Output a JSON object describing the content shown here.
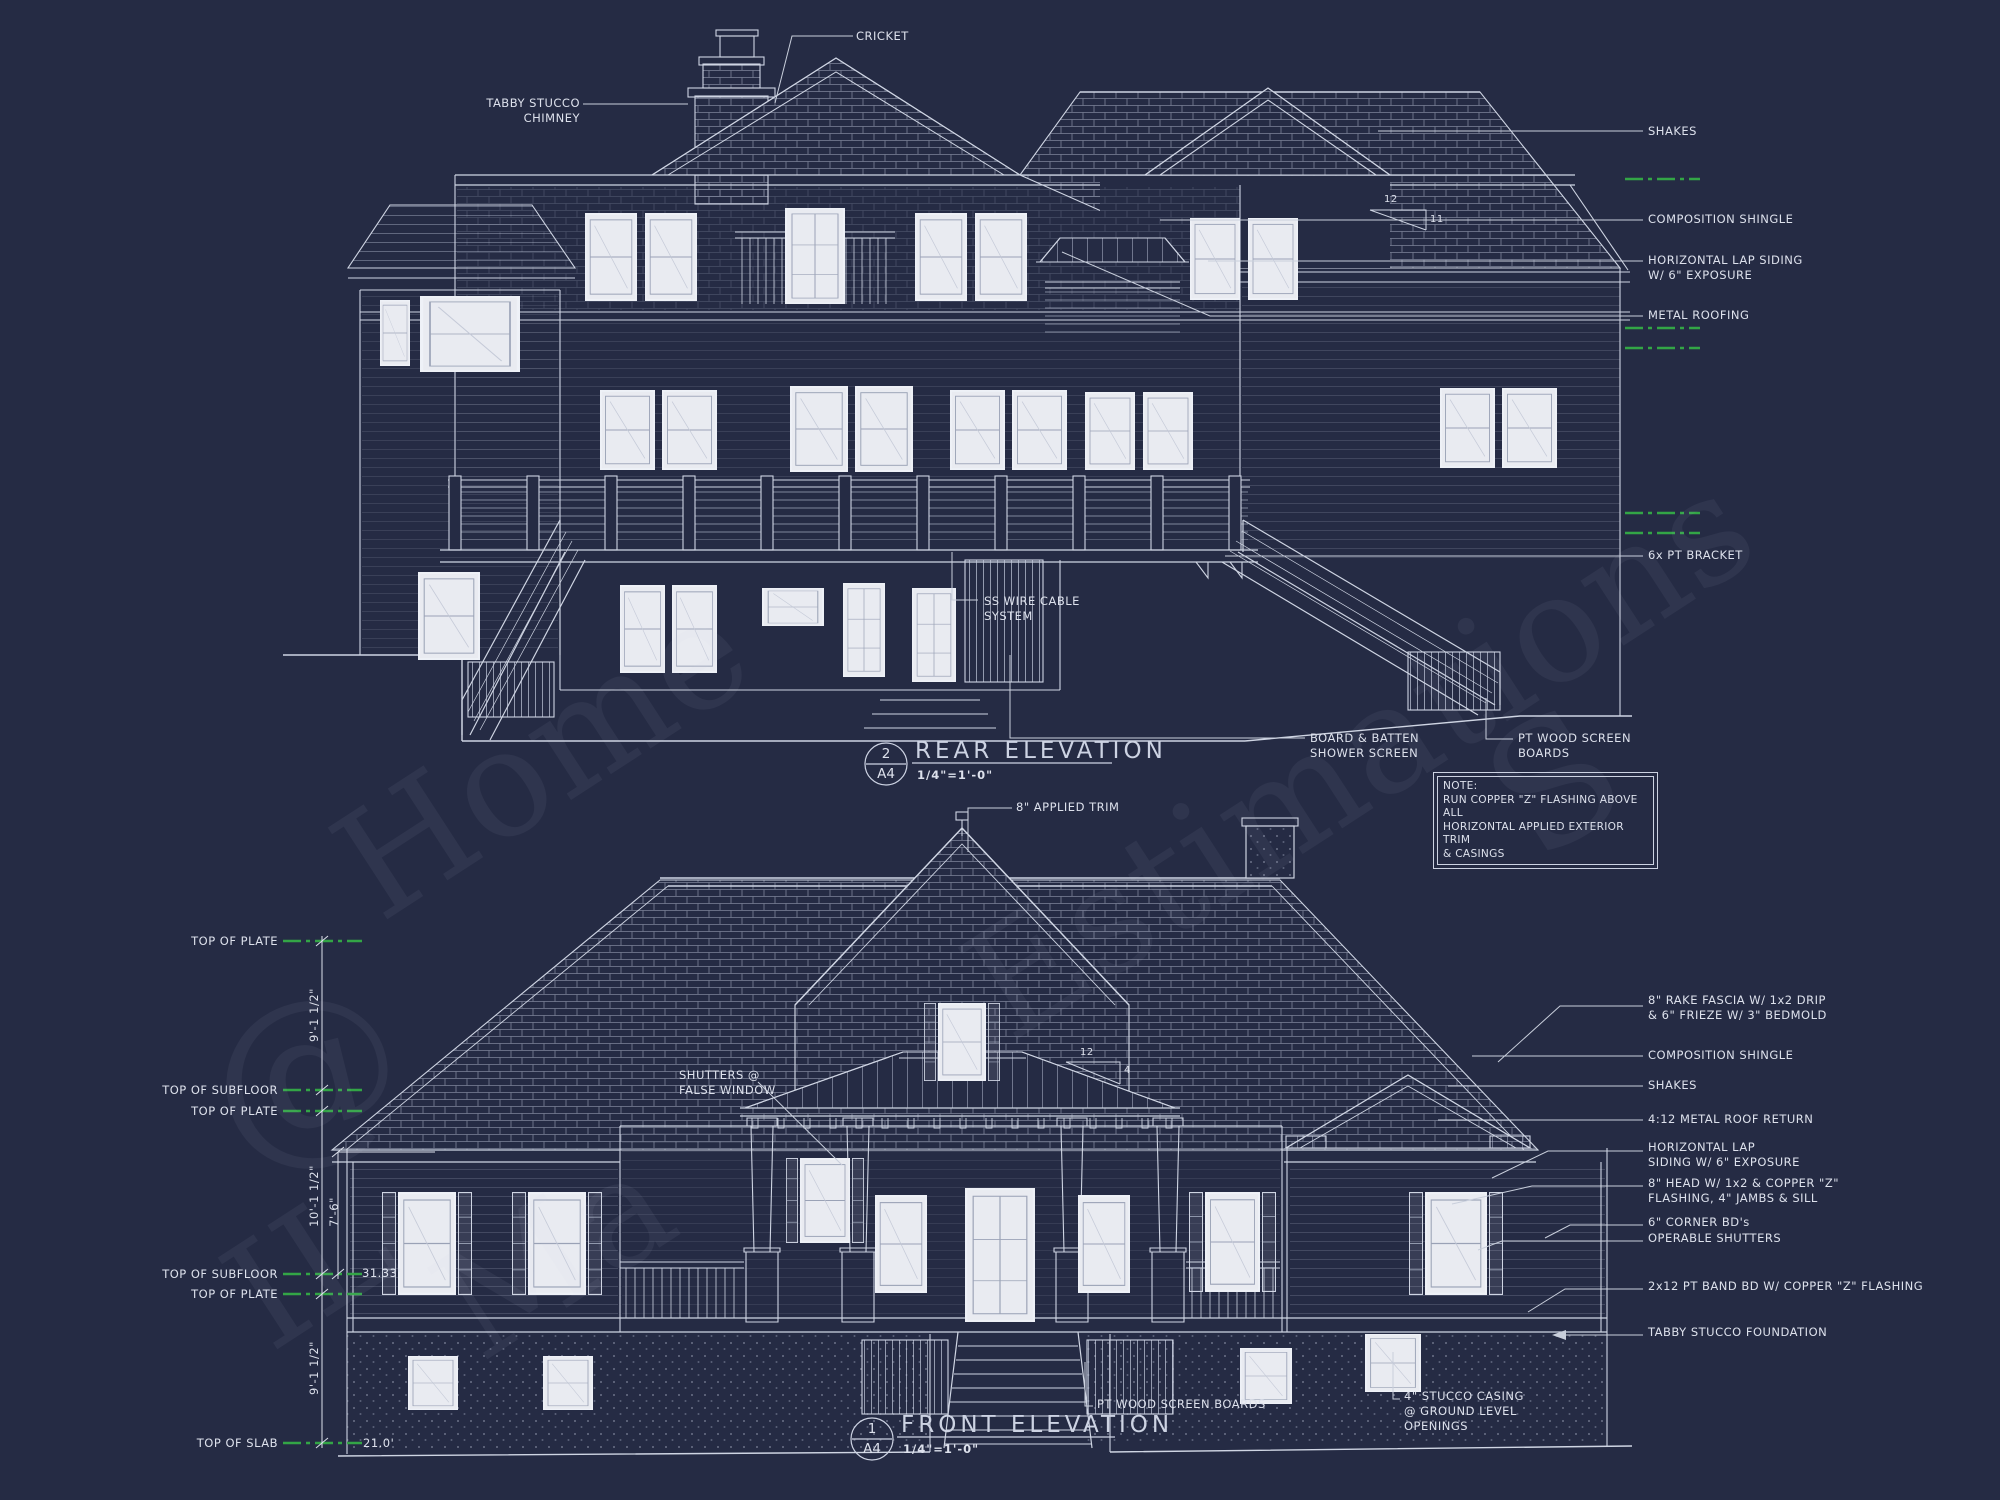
{
  "palette": {
    "background": "#252b44",
    "line": "#cfd5e3",
    "bright_line": "#eef1f7",
    "text": "#dde1ec",
    "green": "#33a546",
    "glass": "#e9ebf1"
  },
  "note": {
    "text": "NOTE:\nRUN COPPER \"Z\" FLASHING ABOVE ALL\nHORIZONTAL APPLIED EXTERIOR TRIM\n& CASINGS"
  },
  "rear": {
    "number": "2",
    "sheet": "A4",
    "title": "REAR ELEVATION",
    "scale": "1/4\"=1'-0\"",
    "pitch": {
      "run": "12",
      "rise": "11"
    },
    "labels": {
      "cricket": "CRICKET",
      "chimney": "TABBY STUCCO\nCHIMNEY",
      "shakes": "SHAKES",
      "comp_shingle": "COMPOSITION SHINGLE",
      "lap_siding": "HORIZONTAL LAP SIDING\nW/ 6\" EXPOSURE",
      "metal_roofing": "METAL ROOFING",
      "pt_bracket": "6x PT BRACKET",
      "ss_wire": "SS WIRE CABLE\nSYSTEM",
      "board_batten": "BOARD & BATTEN\nSHOWER SCREEN",
      "pt_screen": "PT WOOD SCREEN\nBOARDS"
    }
  },
  "front": {
    "number": "1",
    "sheet": "A4",
    "title": "FRONT ELEVATION",
    "scale": "1/4\"=1'-0\"",
    "pitch": {
      "run": "12",
      "rise": "4"
    },
    "labels": {
      "applied_trim": "8\" APPLIED TRIM",
      "false_window": "SHUTTERS @\nFALSE WINDOW",
      "rake_fascia": "8\" RAKE FASCIA W/ 1x2 DRIP\n& 6\" FRIEZE W/ 3\" BEDMOLD",
      "comp_shingle": "COMPOSITION SHINGLE",
      "shakes": "SHAKES",
      "roof_return": "4:12 METAL ROOF RETURN",
      "lap_siding": "HORIZONTAL LAP\nSIDING W/ 6\" EXPOSURE",
      "head": "8\" HEAD W/ 1x2 & COPPER \"Z\"\nFLASHING, 4\" JAMBS & SILL",
      "corner_bds": "6\" CORNER BD's",
      "operable_shutters": "OPERABLE SHUTTERS",
      "band_bd": "2x12 PT BAND BD W/ COPPER \"Z\" FLASHING",
      "tabby_foundation": "TABBY STUCCO FOUNDATION",
      "pt_screen": "PT WOOD SCREEN BOARDS",
      "stucco_casing": "4\" STUCCO CASING\n@ GROUND LEVEL\nOPENINGS"
    }
  },
  "dims": {
    "top_of_plate": "TOP OF PLATE",
    "top_of_subfloor": "TOP OF SUBFLOOR",
    "top_of_slab": "TOP OF SLAB",
    "h_upper": "9'-1 1/2\"",
    "h_main": "10'-1 1/2\"",
    "h_porch": "7'-6\"",
    "h_lower": "9'-1 1/2\"",
    "len_upper": "31.33'",
    "len_lower": "21.0'"
  },
  "watermark": {
    "at": "@",
    "home": "Home",
    "estimations": "Estimations",
    "il": "IL",
    "ma": "Ma",
    "s": "S"
  }
}
